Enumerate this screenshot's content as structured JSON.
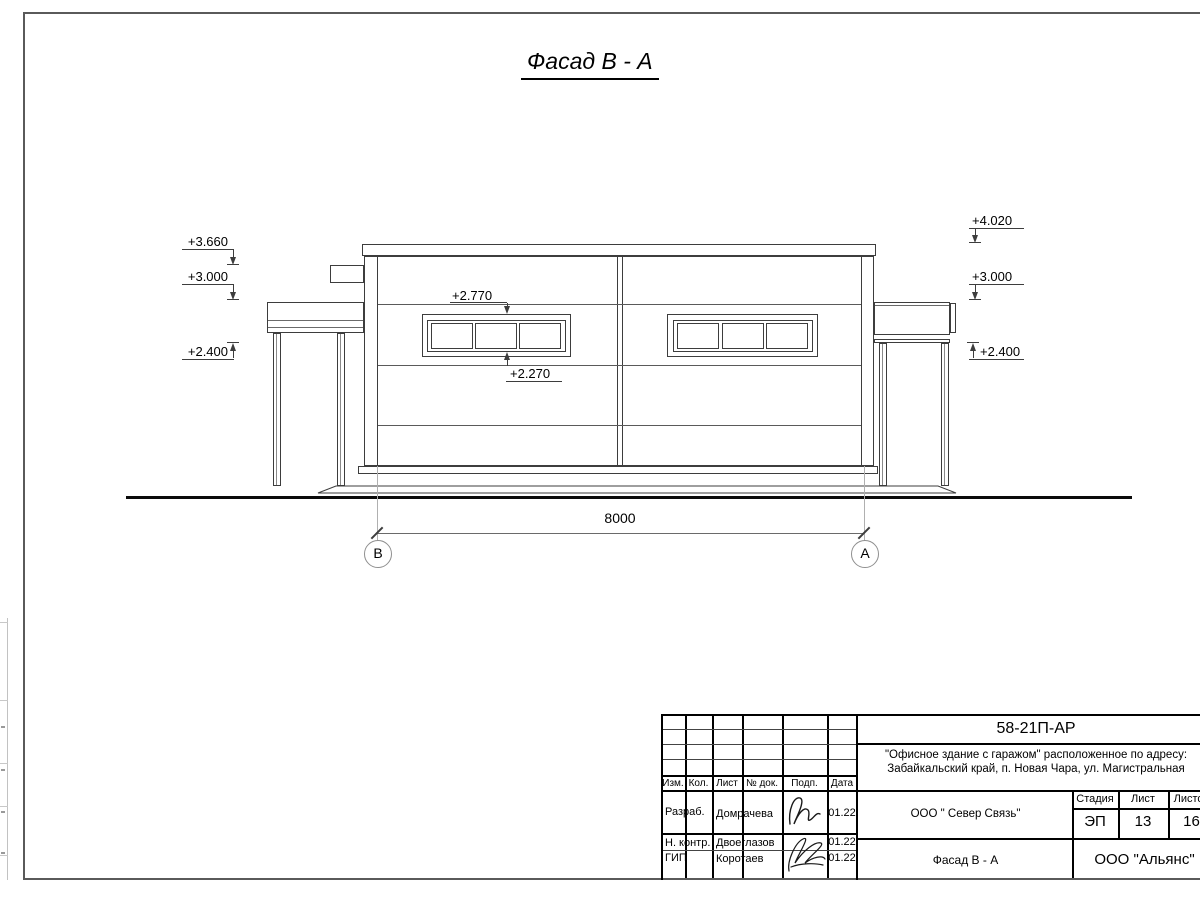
{
  "drawing": {
    "title": "Фасад В - А",
    "dimension": "8000",
    "axis_left": "В",
    "axis_right": "А",
    "marks": {
      "left_3660": "+3.660",
      "left_3000": "+3.000",
      "left_2400": "+2.400",
      "right_4020": "+4.020",
      "right_3000": "+3.000",
      "right_2400": "+2.400",
      "win_top": "+2.770",
      "win_bottom": "+2.270"
    }
  },
  "tb": {
    "doc_code": "58-21П-АР",
    "object_line1": "\"Офисное здание с гаражом\" расположенное по адресу:",
    "object_line2": "Забайкальский край, п. Новая Чара, ул. Магистральная",
    "contractor": "ООО \" Север Связь\"",
    "drawing_name": "Фасад В - А",
    "company": "ООО \"Альянс\"",
    "stage_label": "Стадия",
    "sheet_label": "Лист",
    "sheets_label": "Листов",
    "stage": "ЭП",
    "sheet": "13",
    "sheets": "16",
    "cols": {
      "izm": "Изм.",
      "kol": "Кол.",
      "list": "Лист",
      "ndok": "№ док.",
      "podp": "Подп.",
      "data": "Дата"
    },
    "rows": [
      {
        "role": "Разраб.",
        "name": "Домрачева",
        "date": "01.22"
      },
      {
        "role": "Н. контр.",
        "name": "Двоеглазов",
        "date": "01.22"
      },
      {
        "role": "ГИП",
        "name": "Коротаев",
        "date": "01.22"
      }
    ]
  }
}
